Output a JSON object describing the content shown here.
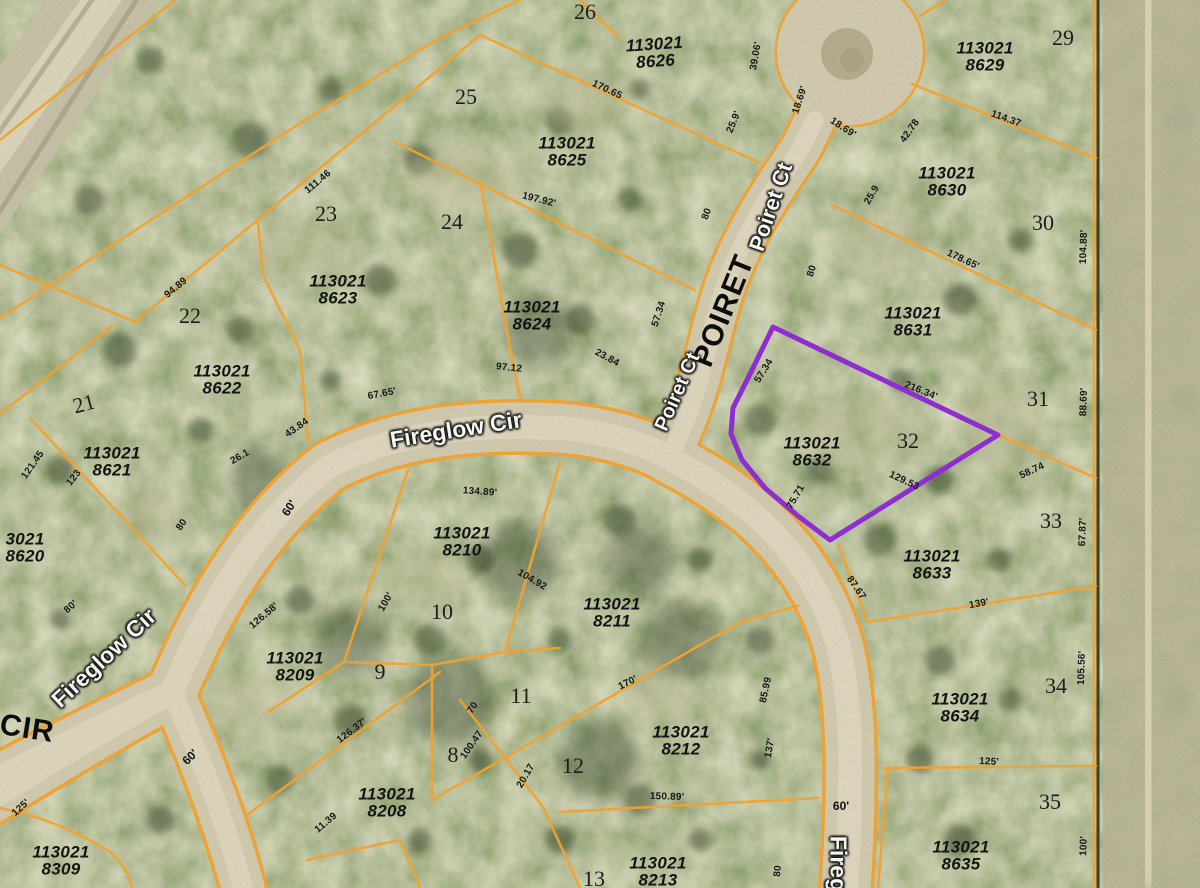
{
  "map": {
    "highlight_color": "#8e2ed0",
    "parcel_line_color": "#f0a232",
    "boundary_dark_color": "#3a4128",
    "streets": [
      {
        "t": "Fireglow Cir",
        "x": 456,
        "y": 430,
        "r": -9,
        "fs": 23,
        "style": "stw"
      },
      {
        "t": "Fireglow Cir",
        "x": 104,
        "y": 658,
        "r": -43,
        "fs": 23,
        "style": "stw"
      },
      {
        "t": "CIR",
        "x": 27,
        "y": 729,
        "r": 9,
        "fs": 30,
        "style": "stb"
      },
      {
        "t": "POIRET",
        "x": 724,
        "y": 311,
        "r": -68,
        "fs": 30,
        "style": "stb"
      },
      {
        "t": "Poiret Ct",
        "x": 771,
        "y": 207,
        "r": -71,
        "fs": 22,
        "style": "stw"
      },
      {
        "t": "Poiret Ct",
        "x": 678,
        "y": 392,
        "r": -66,
        "fs": 20,
        "style": "stw"
      },
      {
        "t": "Fireg",
        "x": 838,
        "y": 864,
        "r": 90,
        "fs": 23,
        "style": "stw"
      }
    ],
    "parcel_ids": [
      {
        "t": "113021\n8626",
        "x": 655,
        "y": 53,
        "r": -4
      },
      {
        "t": "113021\n8629",
        "x": 985,
        "y": 57,
        "r": 0
      },
      {
        "t": "113021\n8625",
        "x": 567,
        "y": 152,
        "r": 0
      },
      {
        "t": "113021\n8630",
        "x": 947,
        "y": 182,
        "r": 0
      },
      {
        "t": "113021\n8623",
        "x": 338,
        "y": 290,
        "r": 0
      },
      {
        "t": "113021\n8624",
        "x": 532,
        "y": 316,
        "r": 0
      },
      {
        "t": "113021\n8631",
        "x": 913,
        "y": 322,
        "r": 0
      },
      {
        "t": "113021\n8622",
        "x": 222,
        "y": 380,
        "r": 0
      },
      {
        "t": "113021\n8632",
        "x": 812,
        "y": 452,
        "r": 0
      },
      {
        "t": "113021\n8621",
        "x": 112,
        "y": 462,
        "r": 0
      },
      {
        "t": "3021\n8620",
        "x": 25,
        "y": 548,
        "r": 0
      },
      {
        "t": "113021\n8210",
        "x": 462,
        "y": 542,
        "r": 0
      },
      {
        "t": "113021\n8633",
        "x": 932,
        "y": 565,
        "r": 0
      },
      {
        "t": "113021\n8211",
        "x": 612,
        "y": 613,
        "r": 0
      },
      {
        "t": "113021\n8209",
        "x": 295,
        "y": 667,
        "r": 0
      },
      {
        "t": "113021\n8634",
        "x": 960,
        "y": 708,
        "r": 0
      },
      {
        "t": "113021\n8212",
        "x": 681,
        "y": 741,
        "r": 0
      },
      {
        "t": "113021\n8208",
        "x": 387,
        "y": 803,
        "r": 0
      },
      {
        "t": "113021\n8635",
        "x": 961,
        "y": 856,
        "r": 0
      },
      {
        "t": "113021\n8309",
        "x": 61,
        "y": 861,
        "r": 0
      },
      {
        "t": "113021\n8213",
        "x": 658,
        "y": 872,
        "r": 0
      }
    ],
    "lot_numbers": [
      {
        "t": "26",
        "x": 585,
        "y": 12,
        "r": 0
      },
      {
        "t": "29",
        "x": 1063,
        "y": 38,
        "r": 0
      },
      {
        "t": "25",
        "x": 466,
        "y": 97,
        "r": 0
      },
      {
        "t": "23",
        "x": 326,
        "y": 214,
        "r": 0
      },
      {
        "t": "24",
        "x": 452,
        "y": 222,
        "r": 0
      },
      {
        "t": "30",
        "x": 1043,
        "y": 223,
        "r": 0
      },
      {
        "t": "22",
        "x": 190,
        "y": 316,
        "r": 0
      },
      {
        "t": "31",
        "x": 1038,
        "y": 399,
        "r": 0
      },
      {
        "t": "21",
        "x": 84,
        "y": 404,
        "r": -15
      },
      {
        "t": "32",
        "x": 908,
        "y": 441,
        "r": 0
      },
      {
        "t": "33",
        "x": 1051,
        "y": 521,
        "r": 0
      },
      {
        "t": "10",
        "x": 442,
        "y": 612,
        "r": 0
      },
      {
        "t": "9",
        "x": 380,
        "y": 672,
        "r": 0
      },
      {
        "t": "34",
        "x": 1056,
        "y": 686,
        "r": 0
      },
      {
        "t": "11",
        "x": 521,
        "y": 696,
        "r": 0
      },
      {
        "t": "8",
        "x": 453,
        "y": 755,
        "r": 0
      },
      {
        "t": "12",
        "x": 573,
        "y": 766,
        "r": 0
      },
      {
        "t": "35",
        "x": 1050,
        "y": 802,
        "r": 0
      },
      {
        "t": "13",
        "x": 594,
        "y": 879,
        "r": 0
      }
    ],
    "road_widths": [
      {
        "t": "60'",
        "x": 289,
        "y": 508,
        "r": -57
      },
      {
        "t": "60'",
        "x": 190,
        "y": 757,
        "r": -45
      },
      {
        "t": "60'",
        "x": 841,
        "y": 806,
        "r": 0
      }
    ],
    "dimensions": [
      {
        "t": "39.06'",
        "x": 756,
        "y": 56,
        "r": -80
      },
      {
        "t": "18.69'",
        "x": 800,
        "y": 100,
        "r": -72
      },
      {
        "t": "18.69'",
        "x": 843,
        "y": 128,
        "r": 33
      },
      {
        "t": "25.9'",
        "x": 734,
        "y": 122,
        "r": -68
      },
      {
        "t": "42.78",
        "x": 910,
        "y": 131,
        "r": -55
      },
      {
        "t": "170.65",
        "x": 607,
        "y": 90,
        "r": 25
      },
      {
        "t": "114.37",
        "x": 1006,
        "y": 119,
        "r": 20
      },
      {
        "t": "111.46",
        "x": 318,
        "y": 182,
        "r": -40
      },
      {
        "t": "25.9",
        "x": 872,
        "y": 195,
        "r": -60
      },
      {
        "t": "197.92'",
        "x": 539,
        "y": 200,
        "r": 14
      },
      {
        "t": "80",
        "x": 707,
        "y": 214,
        "r": -70
      },
      {
        "t": "104.88'",
        "x": 1084,
        "y": 247,
        "r": -88
      },
      {
        "t": "178.65'",
        "x": 963,
        "y": 260,
        "r": 25
      },
      {
        "t": "80",
        "x": 812,
        "y": 271,
        "r": -72
      },
      {
        "t": "94.89",
        "x": 176,
        "y": 288,
        "r": -40
      },
      {
        "t": "57.34",
        "x": 659,
        "y": 314,
        "r": -72
      },
      {
        "t": "23.84",
        "x": 607,
        "y": 358,
        "r": 28
      },
      {
        "t": "97.12",
        "x": 509,
        "y": 368,
        "r": 6
      },
      {
        "t": "57.34",
        "x": 764,
        "y": 371,
        "r": -58
      },
      {
        "t": "216.34'",
        "x": 921,
        "y": 391,
        "r": 22
      },
      {
        "t": "67.65'",
        "x": 382,
        "y": 394,
        "r": -11
      },
      {
        "t": "88.69'",
        "x": 1084,
        "y": 402,
        "r": -88
      },
      {
        "t": "43.84",
        "x": 297,
        "y": 428,
        "r": -35
      },
      {
        "t": "26.1",
        "x": 240,
        "y": 457,
        "r": -30
      },
      {
        "t": "121.45",
        "x": 33,
        "y": 465,
        "r": -55
      },
      {
        "t": "58.74",
        "x": 1032,
        "y": 471,
        "r": -25
      },
      {
        "t": "123",
        "x": 74,
        "y": 478,
        "r": -52
      },
      {
        "t": "129.53",
        "x": 904,
        "y": 481,
        "r": 25
      },
      {
        "t": "134.89'",
        "x": 480,
        "y": 492,
        "r": 4
      },
      {
        "t": "75.71",
        "x": 796,
        "y": 497,
        "r": -60
      },
      {
        "t": "80",
        "x": 182,
        "y": 525,
        "r": -55
      },
      {
        "t": "67.87'",
        "x": 1083,
        "y": 532,
        "r": -88
      },
      {
        "t": "104.92",
        "x": 532,
        "y": 580,
        "r": 30
      },
      {
        "t": "87.67",
        "x": 856,
        "y": 588,
        "r": 55
      },
      {
        "t": "100'",
        "x": 386,
        "y": 602,
        "r": -60
      },
      {
        "t": "139'",
        "x": 979,
        "y": 604,
        "r": -10
      },
      {
        "t": "80'",
        "x": 71,
        "y": 607,
        "r": -42
      },
      {
        "t": "126.58'",
        "x": 264,
        "y": 616,
        "r": -40
      },
      {
        "t": "105.56'",
        "x": 1082,
        "y": 668,
        "r": -88
      },
      {
        "t": "170'",
        "x": 628,
        "y": 683,
        "r": -27
      },
      {
        "t": "85.99",
        "x": 766,
        "y": 690,
        "r": -78
      },
      {
        "t": "70",
        "x": 473,
        "y": 708,
        "r": -55
      },
      {
        "t": "126.37'",
        "x": 352,
        "y": 731,
        "r": -37
      },
      {
        "t": "100.47",
        "x": 472,
        "y": 745,
        "r": -55
      },
      {
        "t": "137'",
        "x": 770,
        "y": 748,
        "r": -80
      },
      {
        "t": "125'",
        "x": 989,
        "y": 762,
        "r": 3
      },
      {
        "t": "20.17",
        "x": 526,
        "y": 776,
        "r": -60
      },
      {
        "t": "150.89'",
        "x": 667,
        "y": 797,
        "r": 2
      },
      {
        "t": "125'",
        "x": 21,
        "y": 808,
        "r": -42
      },
      {
        "t": "11.39",
        "x": 326,
        "y": 823,
        "r": -40
      },
      {
        "t": "100'",
        "x": 1084,
        "y": 846,
        "r": -88
      },
      {
        "t": "80",
        "x": 778,
        "y": 871,
        "r": -85
      }
    ]
  }
}
